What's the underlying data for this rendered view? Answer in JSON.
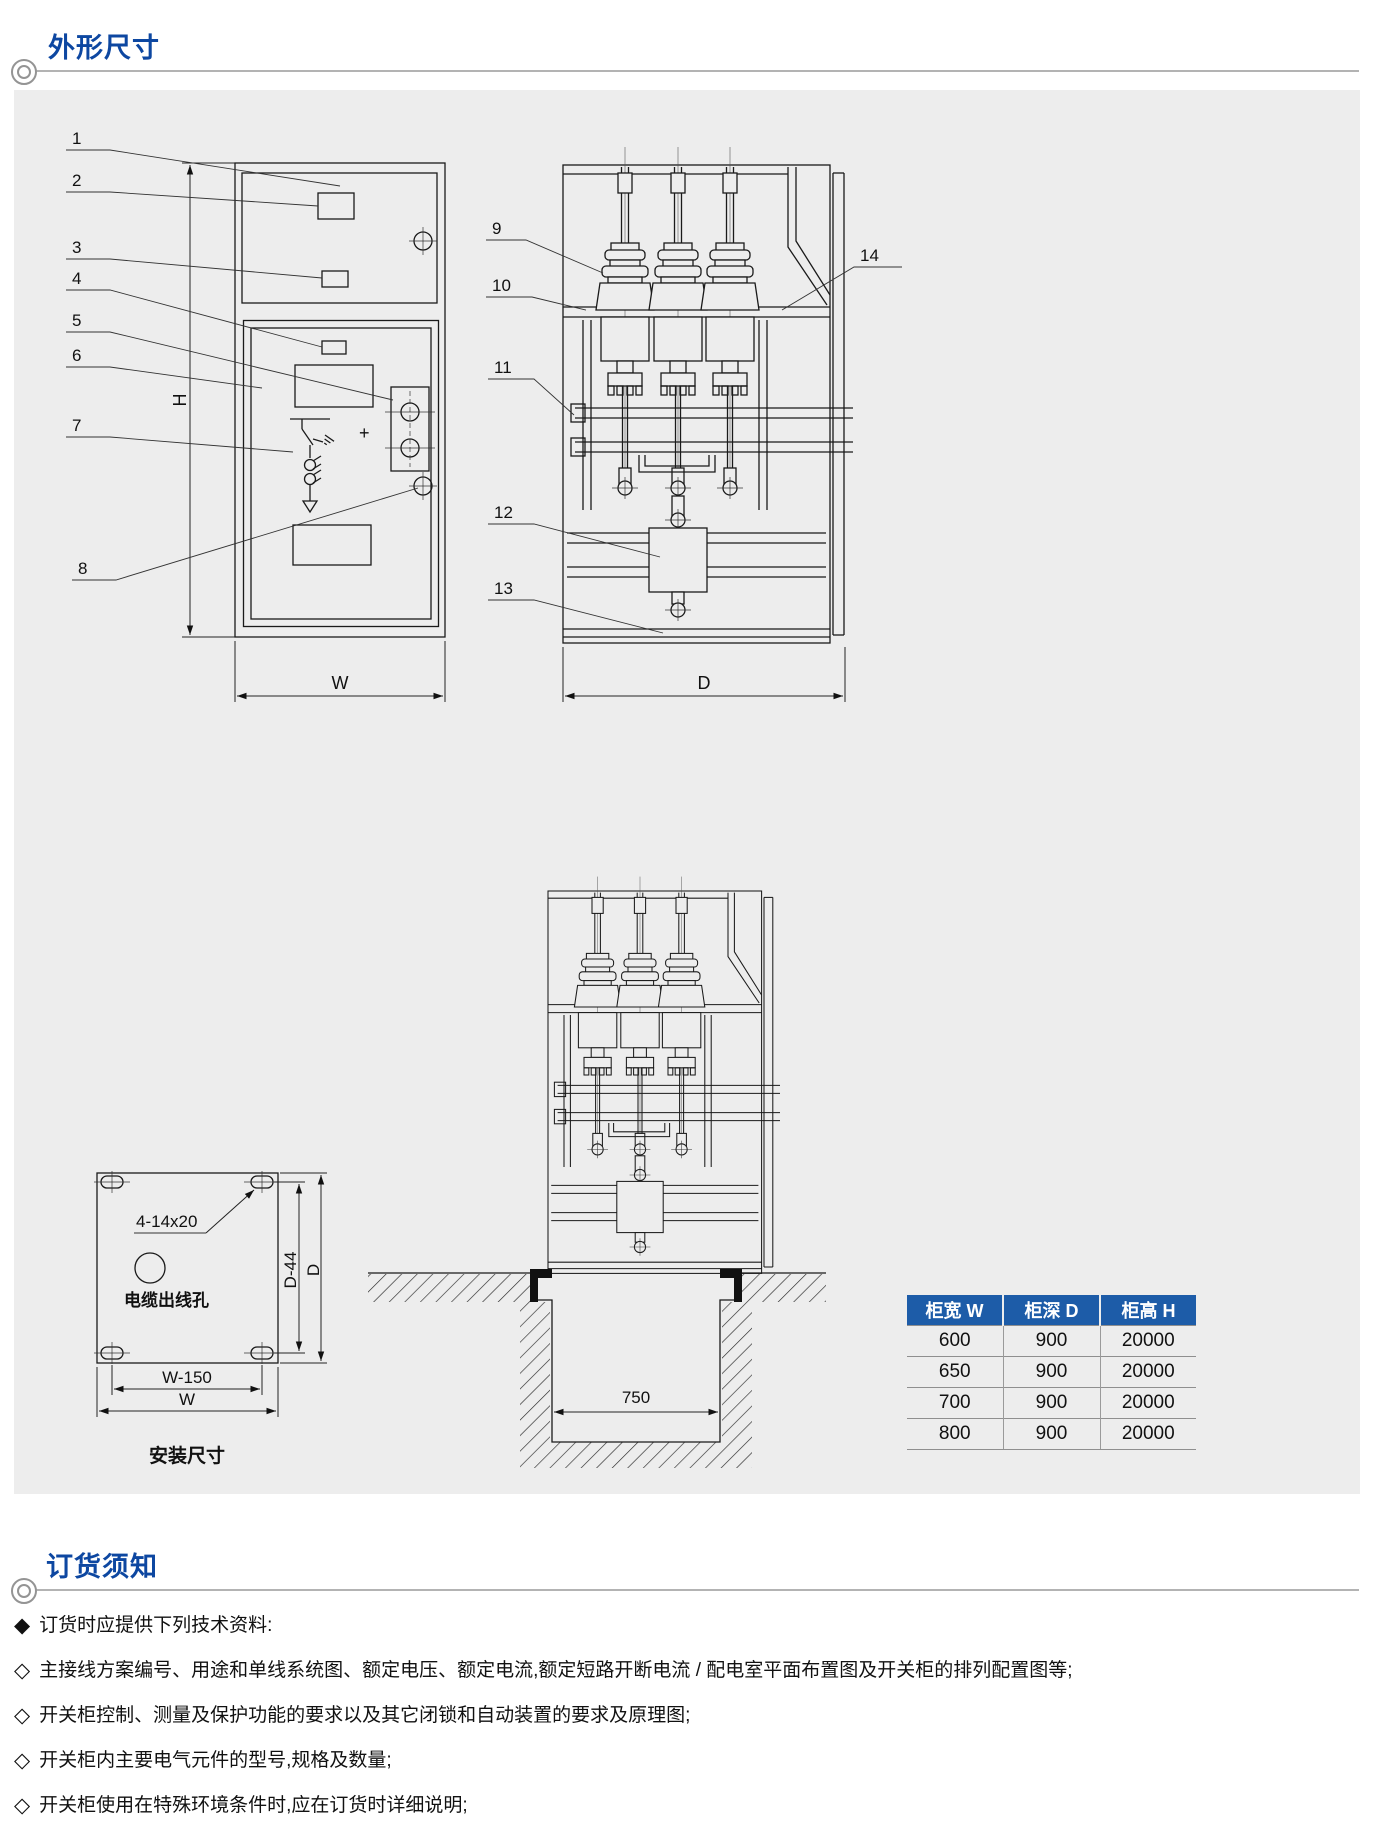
{
  "sections": {
    "dimensions": {
      "title": "外形尺寸"
    },
    "ordering": {
      "title": "订货须知"
    }
  },
  "drawing": {
    "callouts": [
      "1",
      "2",
      "3",
      "4",
      "5",
      "6",
      "7",
      "8",
      "9",
      "10",
      "11",
      "12",
      "13",
      "14"
    ],
    "front_view": {
      "dim_height": "H",
      "dim_width": "W",
      "plus_sign": "+"
    },
    "side_view": {
      "dim_depth": "D"
    },
    "foundation": {
      "trench_width": "750"
    },
    "mounting_plan": {
      "holes_label": "4-14x20",
      "cable_hole_label": "电缆出线孔",
      "dim_w150": "W-150",
      "dim_w": "W",
      "dim_d44": "D-44",
      "dim_d": "D",
      "caption": "安装尺寸"
    }
  },
  "table": {
    "headers": [
      "柜宽 W",
      "柜深 D",
      "柜高 H"
    ],
    "rows": [
      [
        "600",
        "900",
        "20000"
      ],
      [
        "650",
        "900",
        "20000"
      ],
      [
        "700",
        "900",
        "20000"
      ],
      [
        "800",
        "900",
        "20000"
      ]
    ]
  },
  "notes": {
    "items": [
      {
        "bullet": "◆",
        "text": "订货时应提供下列技术资料:"
      },
      {
        "bullet": "◇",
        "text": "主接线方案编号、用途和单线系统图、额定电压、额定电流,额定短路开断电流 / 配电室平面布置图及开关柜的排列配置图等;"
      },
      {
        "bullet": "◇",
        "text": "开关柜控制、测量及保护功能的要求以及其它闭锁和自动装置的要求及原理图;"
      },
      {
        "bullet": "◇",
        "text": "开关柜内主要电气元件的型号,规格及数量;"
      },
      {
        "bullet": "◇",
        "text": "开关柜使用在特殊环境条件时,应在订货时详细说明;"
      }
    ]
  },
  "colors": {
    "accent_blue": "#0d47a1",
    "table_header": "#1d5ca8",
    "panel_bg": "#ededed"
  }
}
